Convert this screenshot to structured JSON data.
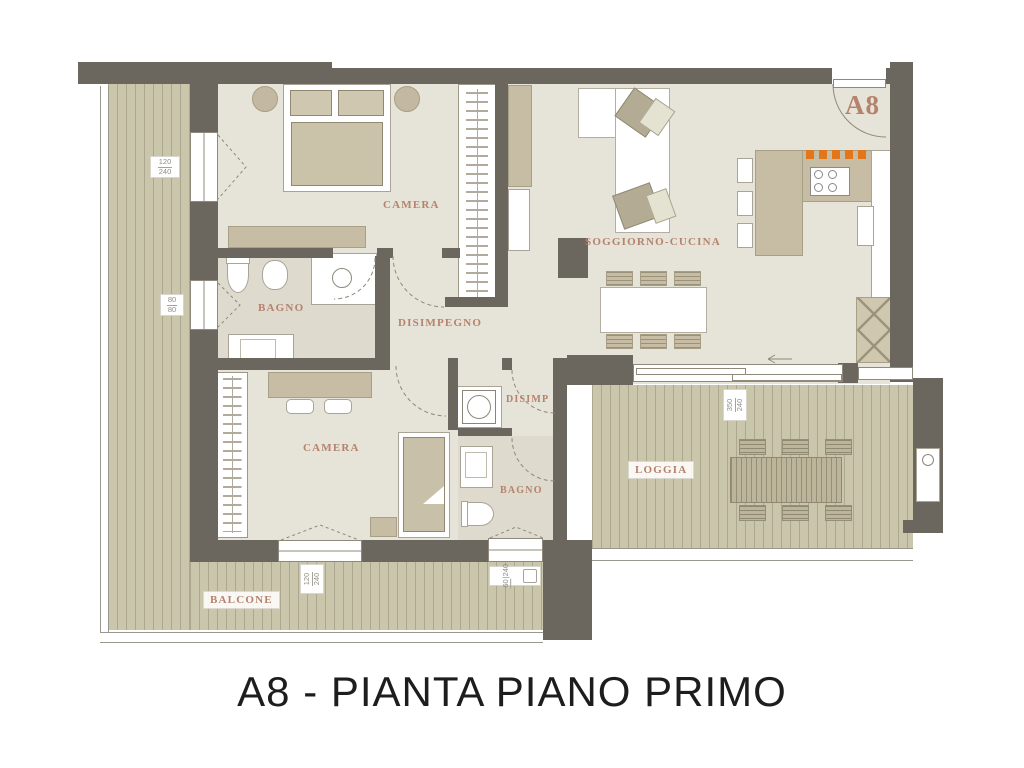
{
  "title": "A8 - PIANTA PIANO PRIMO",
  "unit_label": "A8",
  "rooms": {
    "camera_1": "CAMERA",
    "bagno_1": "BAGNO",
    "disimpegno": "DISIMPEGNO",
    "soggiorno_cucina": "SOGGIORNO-CUCINA",
    "camera_2": "CAMERA",
    "disimp": "DISIMP",
    "bagno_2": "BAGNO",
    "loggia": "LOGGIA",
    "balcone": "BALCONE"
  },
  "dimensions": {
    "camera_1_window": {
      "w": "120",
      "h": "240"
    },
    "bagno_1_window": {
      "w": "80",
      "h": "80"
    },
    "camera_2_window": {
      "w": "120",
      "h": "240"
    },
    "bagno_2_window": {
      "w": "60",
      "h": "240"
    },
    "loggia_door": {
      "w": "350",
      "h": "240"
    }
  },
  "colors": {
    "wall": "#6b675f",
    "floor": "#e6e3d8",
    "deck": "#cac6ab",
    "furniture_tan": "#c6bda4",
    "room_label": "#b5826c",
    "entrance_accent": "#e2761b",
    "title_text": "#1d1d1d"
  }
}
